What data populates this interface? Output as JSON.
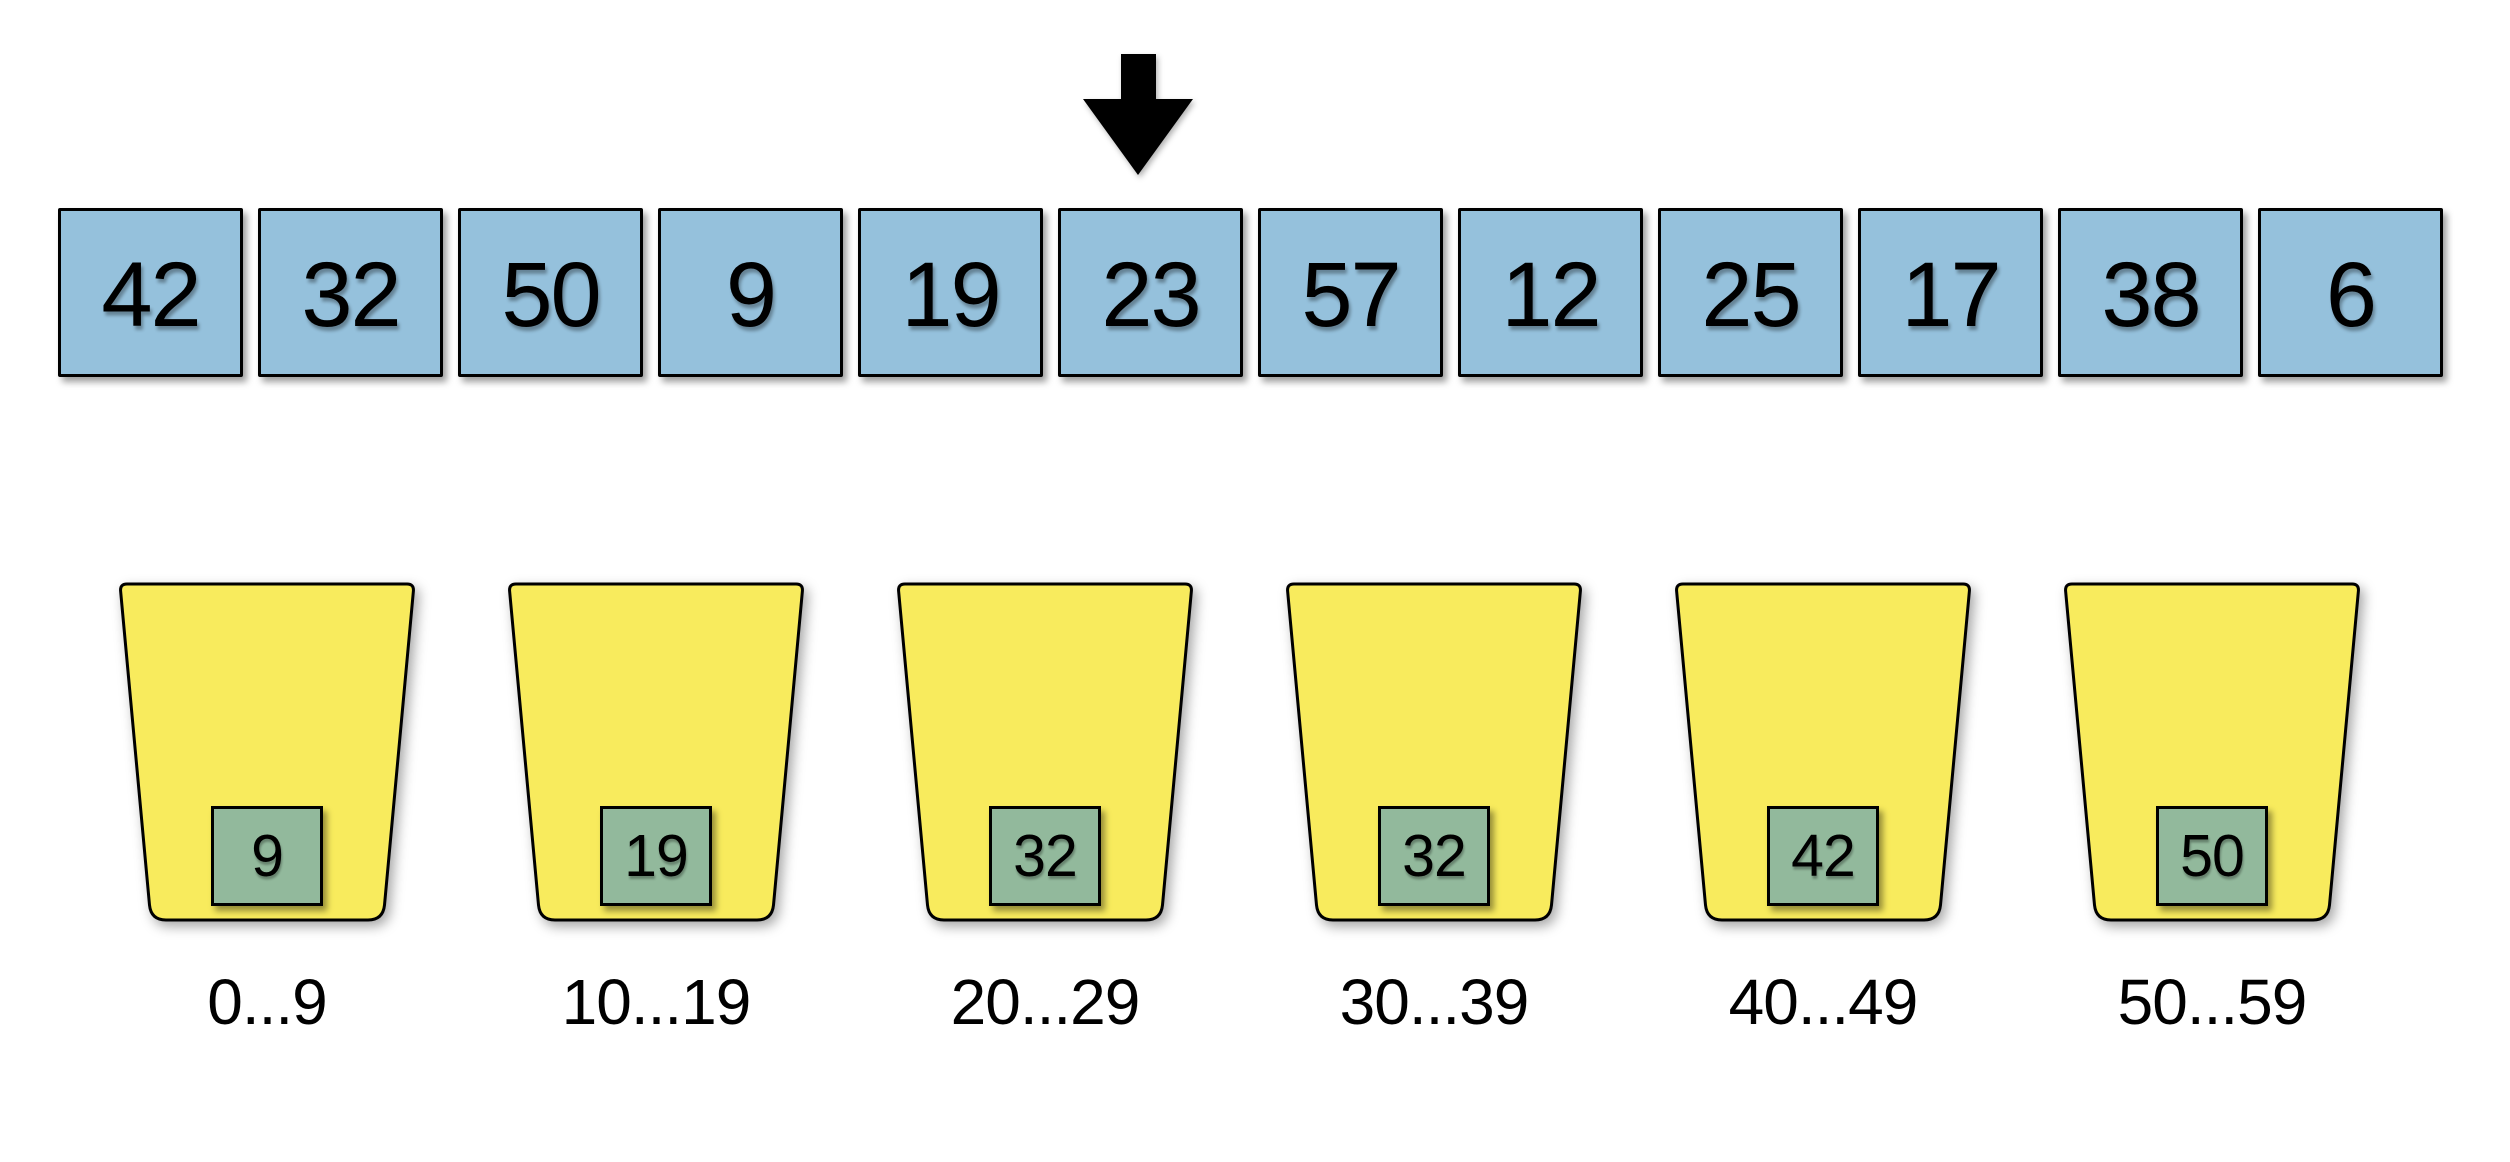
{
  "canvas": {
    "background": "#ffffff",
    "array_cell_color": "#95C1DC",
    "bucket_color": "#F8EB5D",
    "bucket_item_color": "#92B99C",
    "outline_color": "#000000",
    "arrow_color": "#000000"
  },
  "pointer": {
    "target_index": 5,
    "target_value": "23"
  },
  "array": {
    "values": [
      "42",
      "32",
      "50",
      "9",
      "19",
      "23",
      "57",
      "12",
      "25",
      "17",
      "38",
      "6"
    ]
  },
  "buckets": {
    "items": [
      {
        "value": "9",
        "range_label": "0...9"
      },
      {
        "value": "19",
        "range_label": "10...19"
      },
      {
        "value": "32",
        "range_label": "20...29"
      },
      {
        "value": "32",
        "range_label": "30...39"
      },
      {
        "value": "42",
        "range_label": "40...49"
      },
      {
        "value": "50",
        "range_label": "50...59"
      }
    ]
  }
}
